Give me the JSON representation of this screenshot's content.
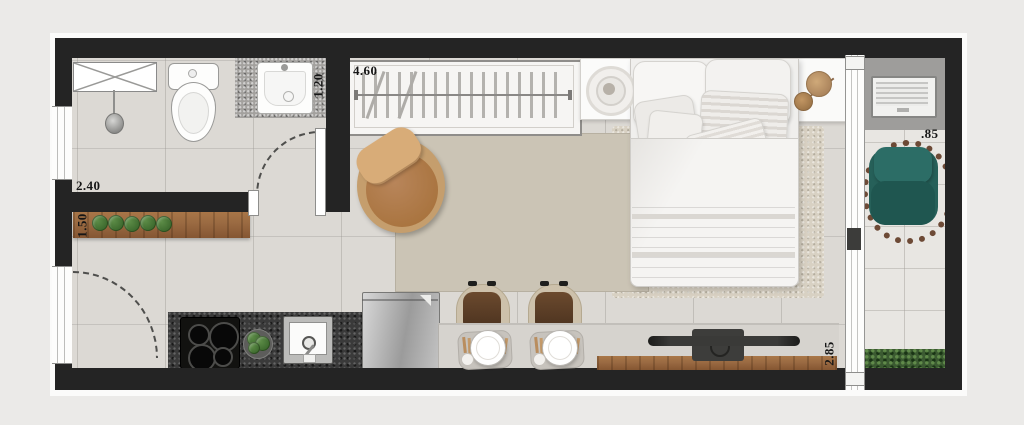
{
  "plan": {
    "type": "studio-apartment-floor-plan",
    "dimensions": {
      "closet_width": "4.60",
      "bathroom_width": "2.40",
      "vanity_depth": "1.20",
      "shelf_length": "1.50",
      "balcony_width": ".85",
      "living_length": "2.85"
    },
    "colors": {
      "wall": "#242424",
      "floor": "#dcd9d4",
      "balcony_floor": "#e8e6e2",
      "granite": "#3a3a3a",
      "wood": "#9a6a42",
      "rug": "#cbc4b5",
      "armchair": "#a9743f",
      "accent_teal": "#2c6d66",
      "hedge_green": "#3b5a31",
      "background": "#ebeae8"
    },
    "rooms": [
      "bathroom",
      "kitchen",
      "living-bedroom",
      "balcony"
    ]
  }
}
